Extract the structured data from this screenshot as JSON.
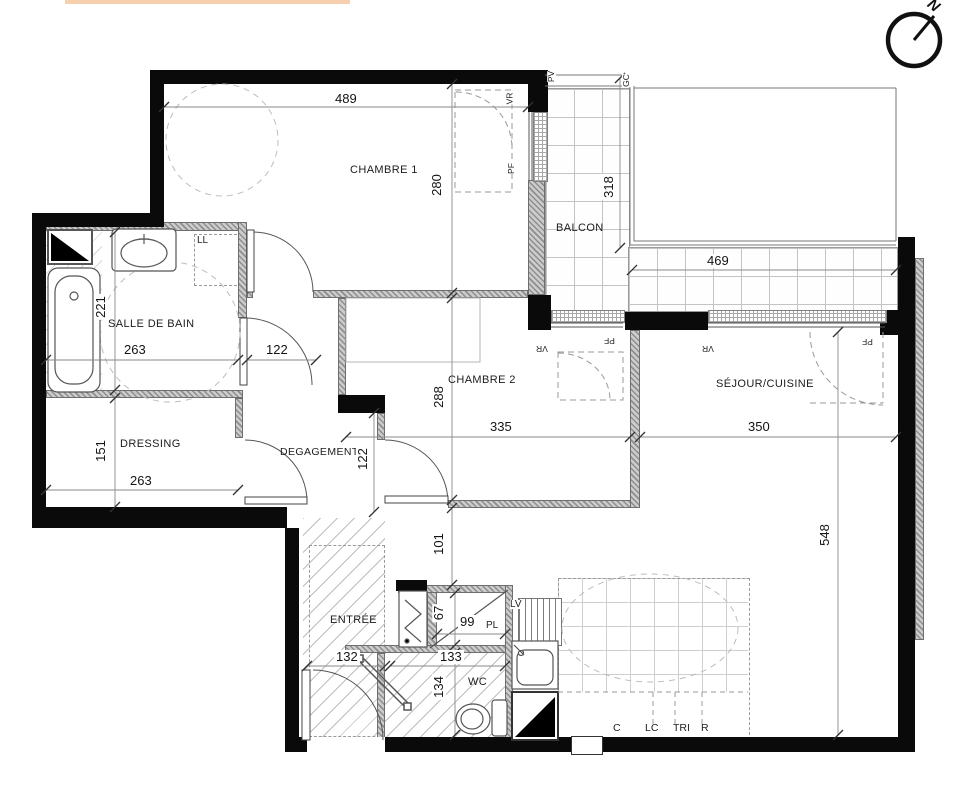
{
  "compass": {
    "label": "N"
  },
  "rooms": {
    "chambre1": "CHAMBRE 1",
    "balcon": "BALCON",
    "salle_de_bain": "SALLE DE BAIN",
    "chambre2": "CHAMBRE 2",
    "sejour": "SÉJOUR/CUISINE",
    "dressing": "DRESSING",
    "degagement": "DEGAGEMENT",
    "entree": "ENTRÉE",
    "wc": "WC"
  },
  "dimensions_cm": {
    "chambre1_width": "489",
    "chambre1_depth": "280",
    "balcon_depth": "318",
    "balcon_width": "469",
    "sdb_width": "263",
    "sdb_depth": "221",
    "sdb_door": "122",
    "dressing_depth": "151",
    "dressing_width": "263",
    "degagement_width": "122",
    "chambre2_depth": "288",
    "chambre2_width": "335",
    "sejour_width": "350",
    "sejour_depth": "548",
    "passage": "101",
    "placard_depth": "67",
    "placard_width": "99",
    "entree_width": "132",
    "wc_width": "133",
    "wc_depth": "134"
  },
  "window_labels": {
    "pv": "PV",
    "gc": "GC",
    "vr": "VR",
    "pf": "PF"
  },
  "fixture_labels": {
    "ll": "LL",
    "lv": "LV",
    "pl": "PL",
    "c": "C",
    "lc": "LC",
    "tri": "TRI",
    "r": "R"
  }
}
